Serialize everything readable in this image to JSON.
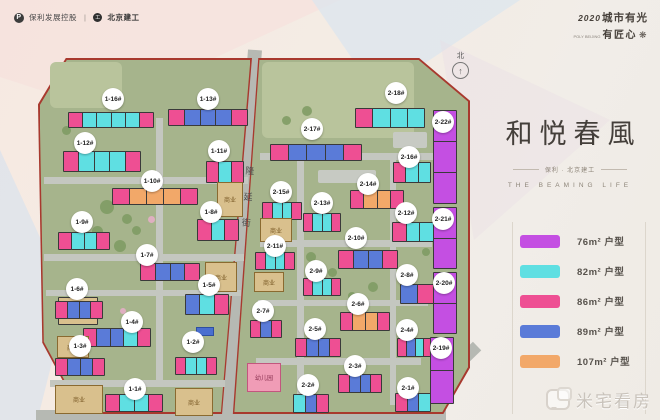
{
  "header": {
    "logo_left_1": "保利发展控股",
    "divider": "|",
    "logo_left_2": "北京建工",
    "slogan_year": "2020",
    "slogan_line1": "城市有光",
    "slogan_sub": "POLY BEIJING",
    "slogan_line2": "有匠心"
  },
  "icons": {
    "flower": "❋",
    "north_arrow": "↑",
    "poly_p": "P",
    "bjce": "工"
  },
  "title_block": {
    "title": "和悦春風",
    "subtitle": "保利 · 北京建工",
    "subtitle_en": "THE BEAMING LIFE"
  },
  "legend": {
    "items": [
      {
        "label": "76m² 户型",
        "color": "#c44fe2"
      },
      {
        "label": "82m² 户型",
        "color": "#5fdfe2"
      },
      {
        "label": "86m² 户型",
        "color": "#ee4f93"
      },
      {
        "label": "89m² 户型",
        "color": "#5a7bd8"
      },
      {
        "label": "107m² 户型",
        "color": "#f2a869"
      }
    ]
  },
  "plan": {
    "north_label": "北",
    "street_name": "隆延街",
    "commercial_label": "商业",
    "kindergarten_label": "幼儿园",
    "colors": {
      "purple": "#c44fe2",
      "cyan": "#5fdfe2",
      "pink": "#ee4f93",
      "blue": "#5a7bd8",
      "orange": "#f2a869",
      "tan": "#d9c08d"
    },
    "buildings": [
      {
        "label": "1-16#",
        "x": 68,
        "y": 112,
        "w": 84,
        "h": 14,
        "segs": [
          "pink",
          "cyan",
          "cyan",
          "cyan",
          "cyan",
          "pink"
        ],
        "bx": 113,
        "by": 99
      },
      {
        "label": "1-13#",
        "x": 168,
        "y": 109,
        "w": 78,
        "h": 15,
        "segs": [
          "pink",
          "blue",
          "blue",
          "blue",
          "pink"
        ],
        "bx": 208,
        "by": 99
      },
      {
        "label": "1-12#",
        "x": 63,
        "y": 151,
        "w": 76,
        "h": 19,
        "segs": [
          "pink",
          "cyan",
          "cyan",
          "cyan",
          "pink"
        ],
        "bx": 85,
        "by": 143
      },
      {
        "label": "1-11#",
        "x": 206,
        "y": 161,
        "w": 36,
        "h": 20,
        "segs": [
          "pink",
          "cyan",
          "pink"
        ],
        "bx": 219,
        "by": 151
      },
      {
        "label": "1-10#",
        "x": 112,
        "y": 188,
        "w": 84,
        "h": 15,
        "segs": [
          "pink",
          "orange",
          "orange",
          "orange",
          "pink"
        ],
        "bx": 152,
        "by": 181
      },
      {
        "label": "1-9#",
        "x": 58,
        "y": 232,
        "w": 50,
        "h": 16,
        "segs": [
          "pink",
          "cyan",
          "cyan",
          "pink"
        ],
        "bx": 82,
        "by": 222
      },
      {
        "label": "1-8#",
        "x": 197,
        "y": 219,
        "w": 40,
        "h": 20,
        "segs": [
          "pink",
          "cyan",
          "pink"
        ],
        "bx": 211,
        "by": 212
      },
      {
        "label": "1-7#",
        "x": 140,
        "y": 263,
        "w": 58,
        "h": 16,
        "segs": [
          "pink",
          "blue",
          "blue",
          "pink"
        ],
        "bx": 147,
        "by": 255
      },
      {
        "label": "1-6#",
        "x": 58,
        "y": 297,
        "w": 38,
        "h": 26,
        "segs": [
          "tan"
        ],
        "biz": true,
        "bx": 77,
        "by": 289
      },
      {
        "label": "1-5#",
        "x": 185,
        "y": 294,
        "w": 42,
        "h": 19,
        "segs": [
          "blue",
          "cyan",
          "pink"
        ],
        "bx": 209,
        "by": 285
      },
      {
        "label": "1-4#",
        "x": 83,
        "y": 328,
        "w": 66,
        "h": 17,
        "segs": [
          "pink",
          "blue",
          "blue",
          "cyan",
          "pink"
        ],
        "bx": 132,
        "by": 322
      },
      {
        "label": "1-3#",
        "x": 55,
        "y": 358,
        "w": 48,
        "h": 16,
        "segs": [
          "pink",
          "blue",
          "blue",
          "pink"
        ],
        "bx": 80,
        "by": 346
      },
      {
        "label": "1-2#",
        "x": 175,
        "y": 357,
        "w": 40,
        "h": 16,
        "segs": [
          "pink",
          "cyan",
          "cyan",
          "pink"
        ],
        "bx": 193,
        "by": 342
      },
      {
        "label": "1-1#",
        "x": 105,
        "y": 394,
        "w": 56,
        "h": 16,
        "segs": [
          "pink",
          "cyan",
          "cyan",
          "pink"
        ],
        "bx": 135,
        "by": 389
      },
      {
        "label": "",
        "x": 55,
        "y": 301,
        "w": 46,
        "h": 16,
        "segs": [
          "pink",
          "blue",
          "blue",
          "pink"
        ]
      },
      {
        "label": "2-17#",
        "x": 270,
        "y": 144,
        "w": 90,
        "h": 15,
        "segs": [
          "pink",
          "blue",
          "blue",
          "blue",
          "pink"
        ],
        "bx": 312,
        "by": 129
      },
      {
        "label": "2-18#",
        "x": 355,
        "y": 108,
        "w": 68,
        "h": 18,
        "segs": [
          "pink",
          "cyan",
          "cyan",
          "cyan"
        ],
        "bx": 396,
        "by": 93
      },
      {
        "label": "2-16#",
        "x": 393,
        "y": 162,
        "w": 36,
        "h": 19,
        "segs": [
          "pink",
          "cyan",
          "cyan"
        ],
        "bx": 409,
        "by": 157
      },
      {
        "label": "2-15#",
        "x": 262,
        "y": 202,
        "w": 38,
        "h": 16,
        "segs": [
          "pink",
          "cyan",
          "cyan",
          "pink"
        ],
        "bx": 281,
        "by": 192
      },
      {
        "label": "2-14#",
        "x": 350,
        "y": 190,
        "w": 52,
        "h": 17,
        "segs": [
          "pink",
          "orange",
          "orange",
          "pink"
        ],
        "bx": 368,
        "by": 184
      },
      {
        "label": "2-13#",
        "x": 303,
        "y": 213,
        "w": 36,
        "h": 17,
        "segs": [
          "pink",
          "cyan",
          "cyan",
          "pink"
        ],
        "bx": 322,
        "by": 203
      },
      {
        "label": "2-12#",
        "x": 392,
        "y": 222,
        "w": 40,
        "h": 18,
        "segs": [
          "pink",
          "cyan",
          "cyan"
        ],
        "bx": 406,
        "by": 213
      },
      {
        "label": "2-11#",
        "x": 255,
        "y": 252,
        "w": 38,
        "h": 16,
        "segs": [
          "pink",
          "cyan",
          "cyan",
          "pink"
        ],
        "bx": 275,
        "by": 246
      },
      {
        "label": "2-10#",
        "x": 338,
        "y": 250,
        "w": 58,
        "h": 17,
        "segs": [
          "pink",
          "blue",
          "blue",
          "pink"
        ],
        "bx": 356,
        "by": 238
      },
      {
        "label": "2-9#",
        "x": 303,
        "y": 278,
        "w": 36,
        "h": 16,
        "segs": [
          "pink",
          "cyan",
          "cyan",
          "pink"
        ],
        "bx": 316,
        "by": 271
      },
      {
        "label": "2-8#",
        "x": 400,
        "y": 284,
        "w": 32,
        "h": 18,
        "segs": [
          "blue",
          "pink"
        ],
        "bx": 407,
        "by": 275
      },
      {
        "label": "2-7#",
        "x": 250,
        "y": 320,
        "w": 30,
        "h": 16,
        "segs": [
          "pink",
          "blue",
          "pink"
        ],
        "bx": 263,
        "by": 311
      },
      {
        "label": "2-6#",
        "x": 340,
        "y": 312,
        "w": 48,
        "h": 17,
        "segs": [
          "pink",
          "orange",
          "orange",
          "pink"
        ],
        "bx": 358,
        "by": 304
      },
      {
        "label": "2-5#",
        "x": 295,
        "y": 338,
        "w": 44,
        "h": 17,
        "segs": [
          "pink",
          "blue",
          "blue",
          "pink"
        ],
        "bx": 315,
        "by": 329
      },
      {
        "label": "2-4#",
        "x": 397,
        "y": 338,
        "w": 34,
        "h": 17,
        "segs": [
          "pink",
          "blue",
          "cyan",
          "pink"
        ],
        "bx": 407,
        "by": 330
      },
      {
        "label": "2-3#",
        "x": 338,
        "y": 374,
        "w": 42,
        "h": 17,
        "segs": [
          "pink",
          "blue",
          "blue",
          "pink"
        ],
        "bx": 355,
        "by": 366
      },
      {
        "label": "2-2#",
        "x": 293,
        "y": 394,
        "w": 34,
        "h": 17,
        "segs": [
          "cyan",
          "blue",
          "pink"
        ],
        "bx": 308,
        "by": 385
      },
      {
        "label": "2-1#",
        "x": 395,
        "y": 393,
        "w": 34,
        "h": 17,
        "segs": [
          "pink",
          "blue",
          "cyan"
        ],
        "bx": 408,
        "by": 388
      },
      {
        "label": "2-22#",
        "x": 433,
        "y": 110,
        "w": 22,
        "h": 92,
        "vert": true,
        "segs": [
          "purple",
          "purple",
          "purple"
        ],
        "bx": 443,
        "by": 122
      },
      {
        "label": "2-21#",
        "x": 433,
        "y": 207,
        "w": 22,
        "h": 60,
        "vert": true,
        "segs": [
          "purple",
          "purple"
        ],
        "bx": 443,
        "by": 219
      },
      {
        "label": "2-20#",
        "x": 433,
        "y": 272,
        "w": 22,
        "h": 60,
        "vert": true,
        "segs": [
          "purple",
          "purple"
        ],
        "bx": 444,
        "by": 283
      },
      {
        "label": "2-19#",
        "x": 430,
        "y": 337,
        "w": 22,
        "h": 65,
        "vert": true,
        "segs": [
          "purple",
          "purple"
        ],
        "bx": 441,
        "by": 348
      }
    ],
    "commercial_blocks": [
      {
        "x": 217,
        "y": 182,
        "w": 24,
        "h": 33
      },
      {
        "x": 205,
        "y": 262,
        "w": 30,
        "h": 28
      },
      {
        "x": 57,
        "y": 336,
        "w": 30,
        "h": 20
      },
      {
        "x": 55,
        "y": 385,
        "w": 46,
        "h": 27
      },
      {
        "x": 175,
        "y": 388,
        "w": 36,
        "h": 26
      },
      {
        "x": 260,
        "y": 218,
        "w": 30,
        "h": 22
      },
      {
        "x": 254,
        "y": 272,
        "w": 28,
        "h": 18
      }
    ],
    "kindergarten": {
      "x": 247,
      "y": 363,
      "w": 32,
      "h": 27
    }
  },
  "watermark": {
    "text": "米宅看房"
  }
}
